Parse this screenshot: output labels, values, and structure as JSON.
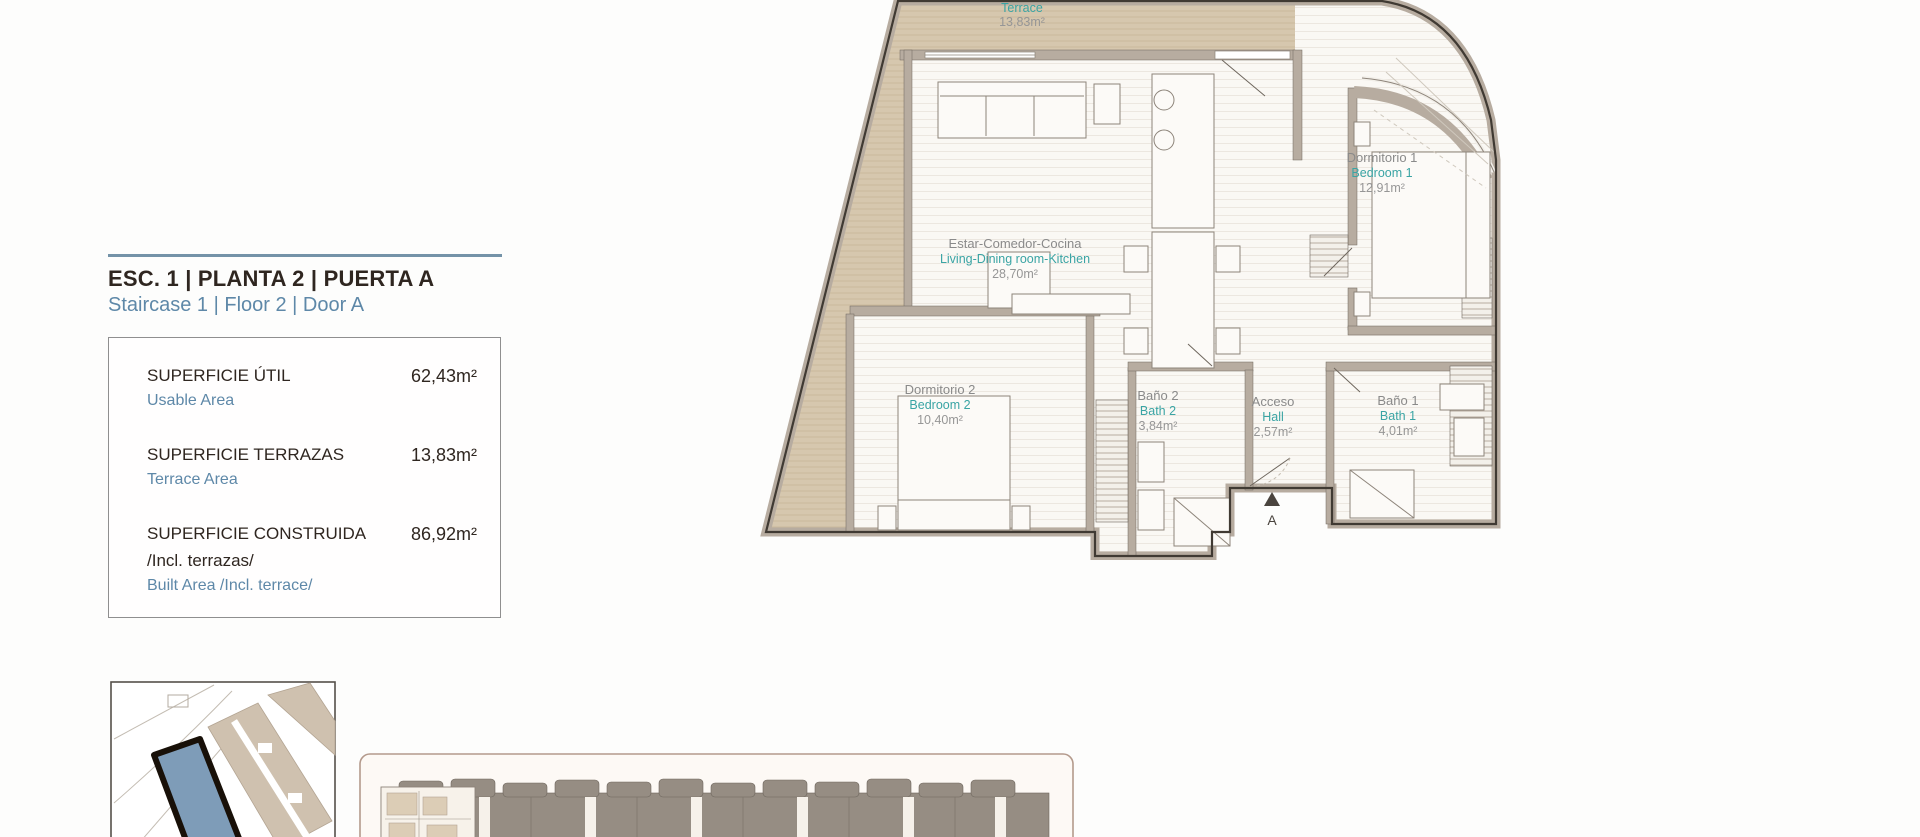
{
  "colors": {
    "accent_blue": "#5e88a8",
    "teal": "#3aa4a4",
    "label_gray": "#8a8a8a",
    "dark_text": "#2f2620",
    "wall_fill": "#b7aca0",
    "wall_outline": "#403a33",
    "terrace_fill": "#d6c7ae",
    "site_building_blue": "#7e9cb8",
    "strip_building_gray": "#968d83"
  },
  "info_panel": {
    "title_es": "ESC. 1 | PLANTA 2 | PUERTA A",
    "title_en": "Staircase 1 | Floor 2 | Door A",
    "rows": [
      {
        "label_es": "SUPERFICIE ÚTIL",
        "label_en": "Usable Area",
        "value": "62,43m²"
      },
      {
        "label_es": "SUPERFICIE TERRAZAS",
        "label_en": "Terrace Area",
        "value": "13,83m²"
      },
      {
        "label_es": "SUPERFICIE CONSTRUIDA",
        "label_es_2": "/Incl. terrazas/",
        "label_en": "Built Area /Incl. terrace/",
        "value": "86,92m²"
      }
    ]
  },
  "floor_plan": {
    "rooms": {
      "terrace": {
        "name_en": "Terrace",
        "area": "13,83m²"
      },
      "living": {
        "name_es": "Estar-Comedor-Cocina",
        "name_en": "Living-Dining room-Kitchen",
        "area": "28,70m²"
      },
      "bedroom1": {
        "name_es": "Dormitorio 1",
        "name_en": "Bedroom 1",
        "area": "12,91m²"
      },
      "bedroom2": {
        "name_es": "Dormitorio 2",
        "name_en": "Bedroom 2",
        "area": "10,40m²"
      },
      "bath2": {
        "name_es": "Baño 2",
        "name_en": "Bath 2",
        "area": "3,84m²"
      },
      "hall": {
        "name_es": "Acceso",
        "name_en": "Hall",
        "area": "2,57m²"
      },
      "bath1": {
        "name_es": "Baño 1",
        "name_en": "Bath 1",
        "area": "4,01m²"
      }
    },
    "entrance_label": "A"
  }
}
